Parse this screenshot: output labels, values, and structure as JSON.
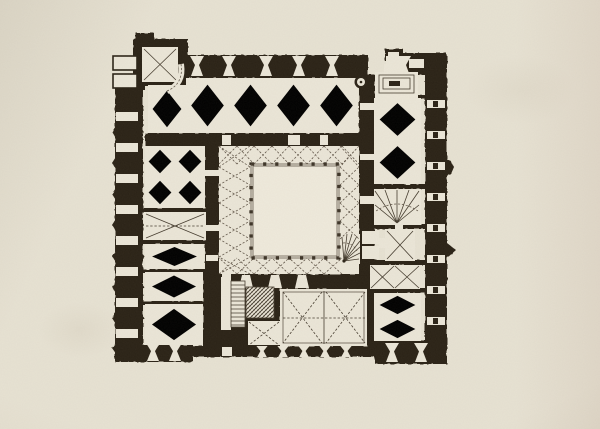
{
  "artwork": {
    "kind": "engraved architectural floor plan",
    "subject": "quadrangular castle ground plan with central arcaded courtyard",
    "technique": "woodcut-style print on cream laid paper"
  },
  "palette": {
    "paper": "#e7e2d3",
    "room": "#ebe6d8",
    "courtyard": "#efeadc",
    "ink": "#2b2317",
    "rib": "#5c5144",
    "line": "#453c2f"
  },
  "plan": {
    "regions": [
      {
        "name": "northwest-stair-tower",
        "vault": "cross vault"
      },
      {
        "name": "north-hall",
        "vault": "net vault, 4 bays"
      },
      {
        "name": "west-wing-room-1",
        "vault": "star vault, 2x2 bays"
      },
      {
        "name": "west-wing-room-2",
        "vault": "cross vault"
      },
      {
        "name": "west-wing-room-3",
        "vault": "star vault"
      },
      {
        "name": "west-wing-room-4",
        "vault": "star vault"
      },
      {
        "name": "west-wing-room-5",
        "vault": "star vault"
      },
      {
        "name": "cloister-walk",
        "vault": "cross-vaulted bays around courtyard"
      },
      {
        "name": "courtyard",
        "vault": "open to sky"
      },
      {
        "name": "southeast-spiral-stair",
        "vault": "winder stair"
      },
      {
        "name": "south-hall",
        "vault": "cross vault, 2 bays"
      },
      {
        "name": "south-straight-stair",
        "vault": "straight flight"
      },
      {
        "name": "hatched-masonry-block",
        "vault": "solid masonry"
      },
      {
        "name": "east-wing-hall",
        "vault": "star vault, 2 bays"
      },
      {
        "name": "east-wing-fan-room",
        "vault": "fan vault"
      },
      {
        "name": "east-wing-chamber",
        "vault": "cross vault"
      },
      {
        "name": "east-wing-double-bay",
        "vault": "cross vault, 2 bays"
      },
      {
        "name": "southeast-corner-room",
        "vault": "star vault, 2 bays"
      },
      {
        "name": "northeast-stair",
        "vault": "straight dog-leg stair"
      }
    ]
  }
}
